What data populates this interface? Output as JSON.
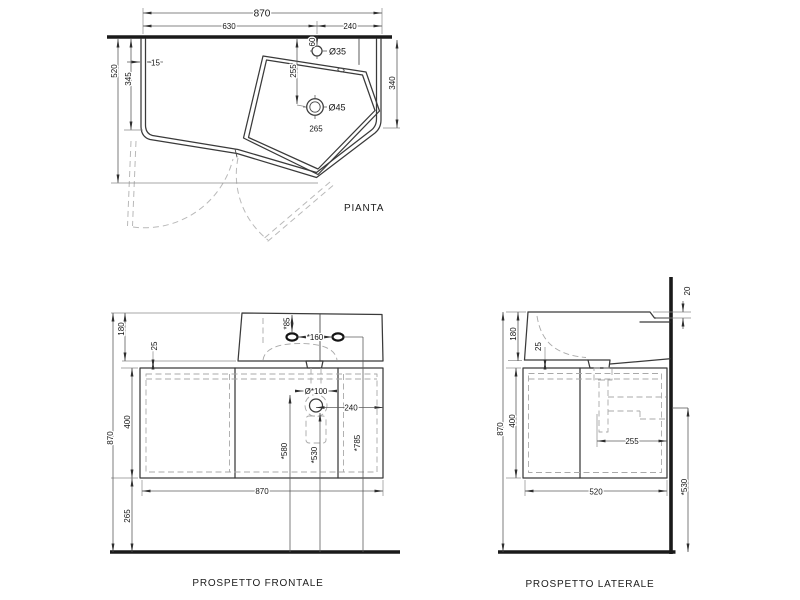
{
  "drawing_title": "Washbasin technical drawing",
  "colors": {
    "line": "#3a3a3a",
    "hidden": "#a9a9a9",
    "text": "#161616",
    "background": "#ffffff"
  },
  "views": {
    "pianta": {
      "title": "PIANTA",
      "dims": {
        "overall_width": "870",
        "left_section": "630",
        "right_section": "240",
        "total_depth": "520",
        "left_depth": "345",
        "panel_thickness": "15",
        "faucet_hole_dia": "Ø35",
        "faucet_from_wall": "60",
        "drain_from_wall": "255",
        "drain_dia": "Ø45",
        "drain_offset": "265",
        "right_depth": "340"
      }
    },
    "frontale": {
      "title": "PROSPETTO FRONTALE",
      "dims": {
        "basin_height": "180",
        "top_gap": "25",
        "total_height": "870",
        "cabinet_height": "400",
        "floor_clearance": "265",
        "faucet_depth": "*85",
        "holes_spacing": "*160",
        "siphon_hole_dia": "Ø*100",
        "drain_to_edge": "240",
        "ref_height_580": "*580",
        "ref_height_530": "*530",
        "ref_height_785": "*785",
        "overall_width": "870"
      }
    },
    "laterale": {
      "title": "PROSPETTO LATERALE",
      "dims": {
        "wall_step": "20",
        "basin_height": "180",
        "top_gap": "25",
        "total_height": "870",
        "cabinet_height": "400",
        "drain_to_wall": "255",
        "depth": "520",
        "ref_height_530": "*530"
      }
    }
  }
}
